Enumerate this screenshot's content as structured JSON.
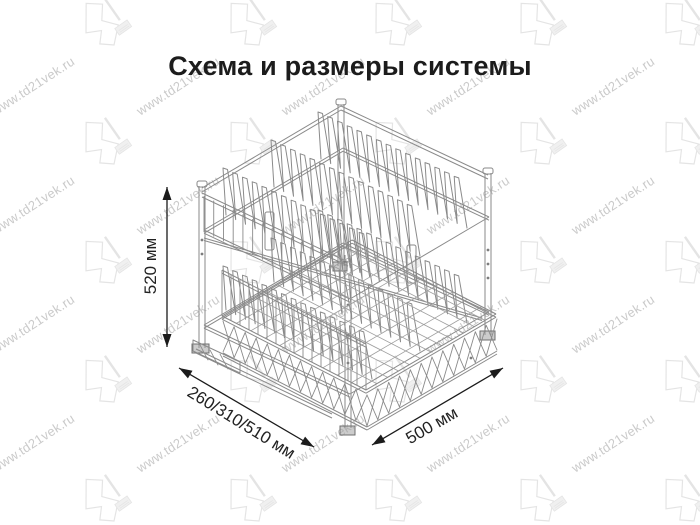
{
  "title": "Схема и размеры системы",
  "diagram": {
    "alt": "Изометрический чертёж двухуровневой выдвижной сушки для посуды с нижней сетчатой корзиной",
    "dimensions": {
      "height": "520 мм",
      "depth": "260/310/510 мм",
      "width": "500 мм"
    },
    "colors": {
      "line": "#8a8a8a",
      "mesh": "#9e9e9e",
      "dimension": "#1b1b1b",
      "background": "#ffffff"
    }
  },
  "watermark": {
    "url_text": "www.td21vek.ru",
    "logo_text": "21",
    "text_color": "#9f9f9f",
    "logo_color": "#e2e2e2"
  }
}
